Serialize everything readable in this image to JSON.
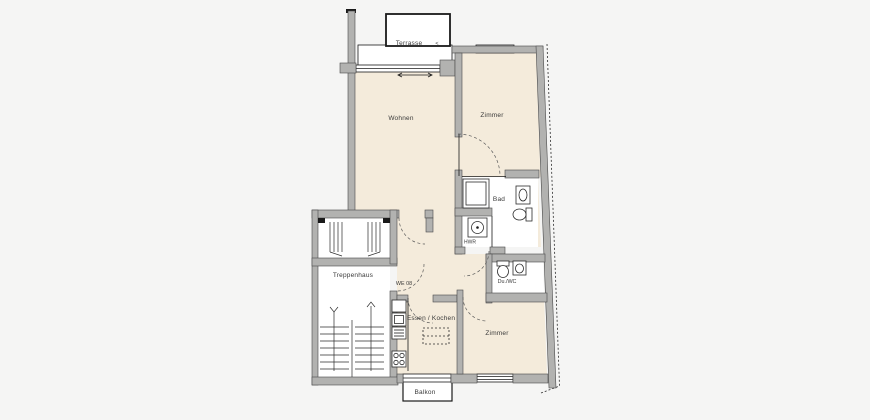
{
  "labels": {
    "terrasse": "Terrasse",
    "terrasse_mark": "<",
    "wohnen": "Wohnen",
    "zimmer_top": "Zimmer",
    "bad": "Bad",
    "hwr": "HWR",
    "duwc": "Du./WC",
    "treppenhaus": "Treppenhaus",
    "we_number": "WE 08",
    "essen_kochen": "Essen / Kochen",
    "zimmer_bottom": "Zimmer",
    "balkon": "Balkon"
  },
  "colors": {
    "bg": "#f5f5f4",
    "floor": "#f4ebdb",
    "wall": "#b2b2b0",
    "line": "#1a1a1a"
  },
  "rooms": [
    {
      "label": "Terrasse"
    },
    {
      "label": "Wohnen"
    },
    {
      "label": "Zimmer"
    },
    {
      "label": "Bad"
    },
    {
      "label": "HWR"
    },
    {
      "label": "Du./WC"
    },
    {
      "label": "Treppenhaus"
    },
    {
      "label": "Essen / Kochen"
    },
    {
      "label": "Zimmer"
    },
    {
      "label": "Balkon"
    }
  ]
}
